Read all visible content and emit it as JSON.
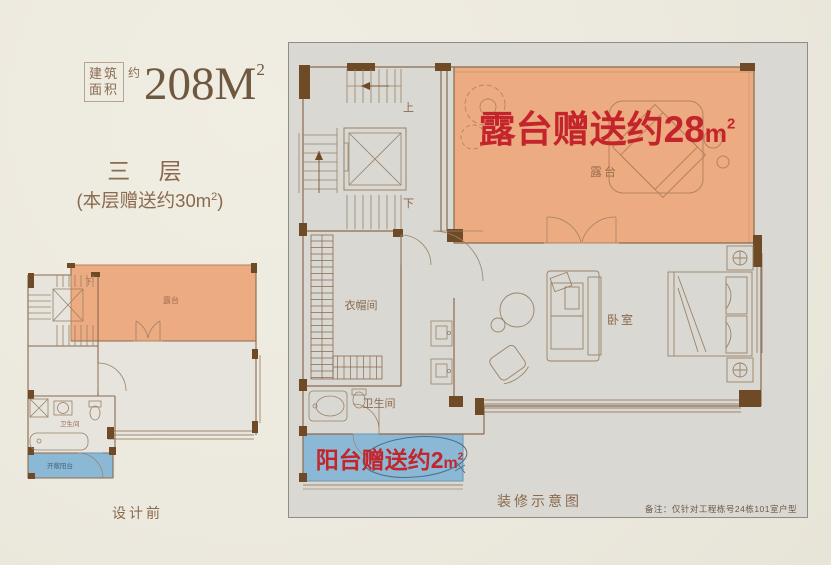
{
  "header": {
    "area_row1": "建筑",
    "area_row2": "面积",
    "area_approx": "约",
    "area_value": "208M",
    "area_sup": "2"
  },
  "left": {
    "floor_title": "三 层",
    "bonus_prefix": "(本层赠送约30m",
    "bonus_sup": "2",
    "bonus_close": ")",
    "caption": "设计前",
    "labels": {
      "terrace": "露台",
      "bathroom": "卫生间",
      "balcony": "开敞阳台",
      "down": "下"
    }
  },
  "main": {
    "banner_terrace": {
      "text": "露台赠送约28",
      "unit": "m",
      "sup": "2"
    },
    "terrace_label": "露台",
    "up": "上",
    "down": "下",
    "cloakroom": "衣帽间",
    "bathroom": "卫生间",
    "bedroom": "卧室",
    "banner_balcony": {
      "text": "阳台赠送约2",
      "unit": "m",
      "sup": "2"
    },
    "caption": "装修示意图",
    "note": "备注：仅针对工程栋号24栋101室户型"
  },
  "colors": {
    "paper": "#ece9de",
    "panel_gray": "#d9d8d3",
    "accent_red": "#c4242b",
    "terrace_salmon": "#ecab81",
    "balcony_blue": "#8bb9d5",
    "brown_text": "#8a6a4e",
    "wall_dark": "#6f4a26"
  }
}
